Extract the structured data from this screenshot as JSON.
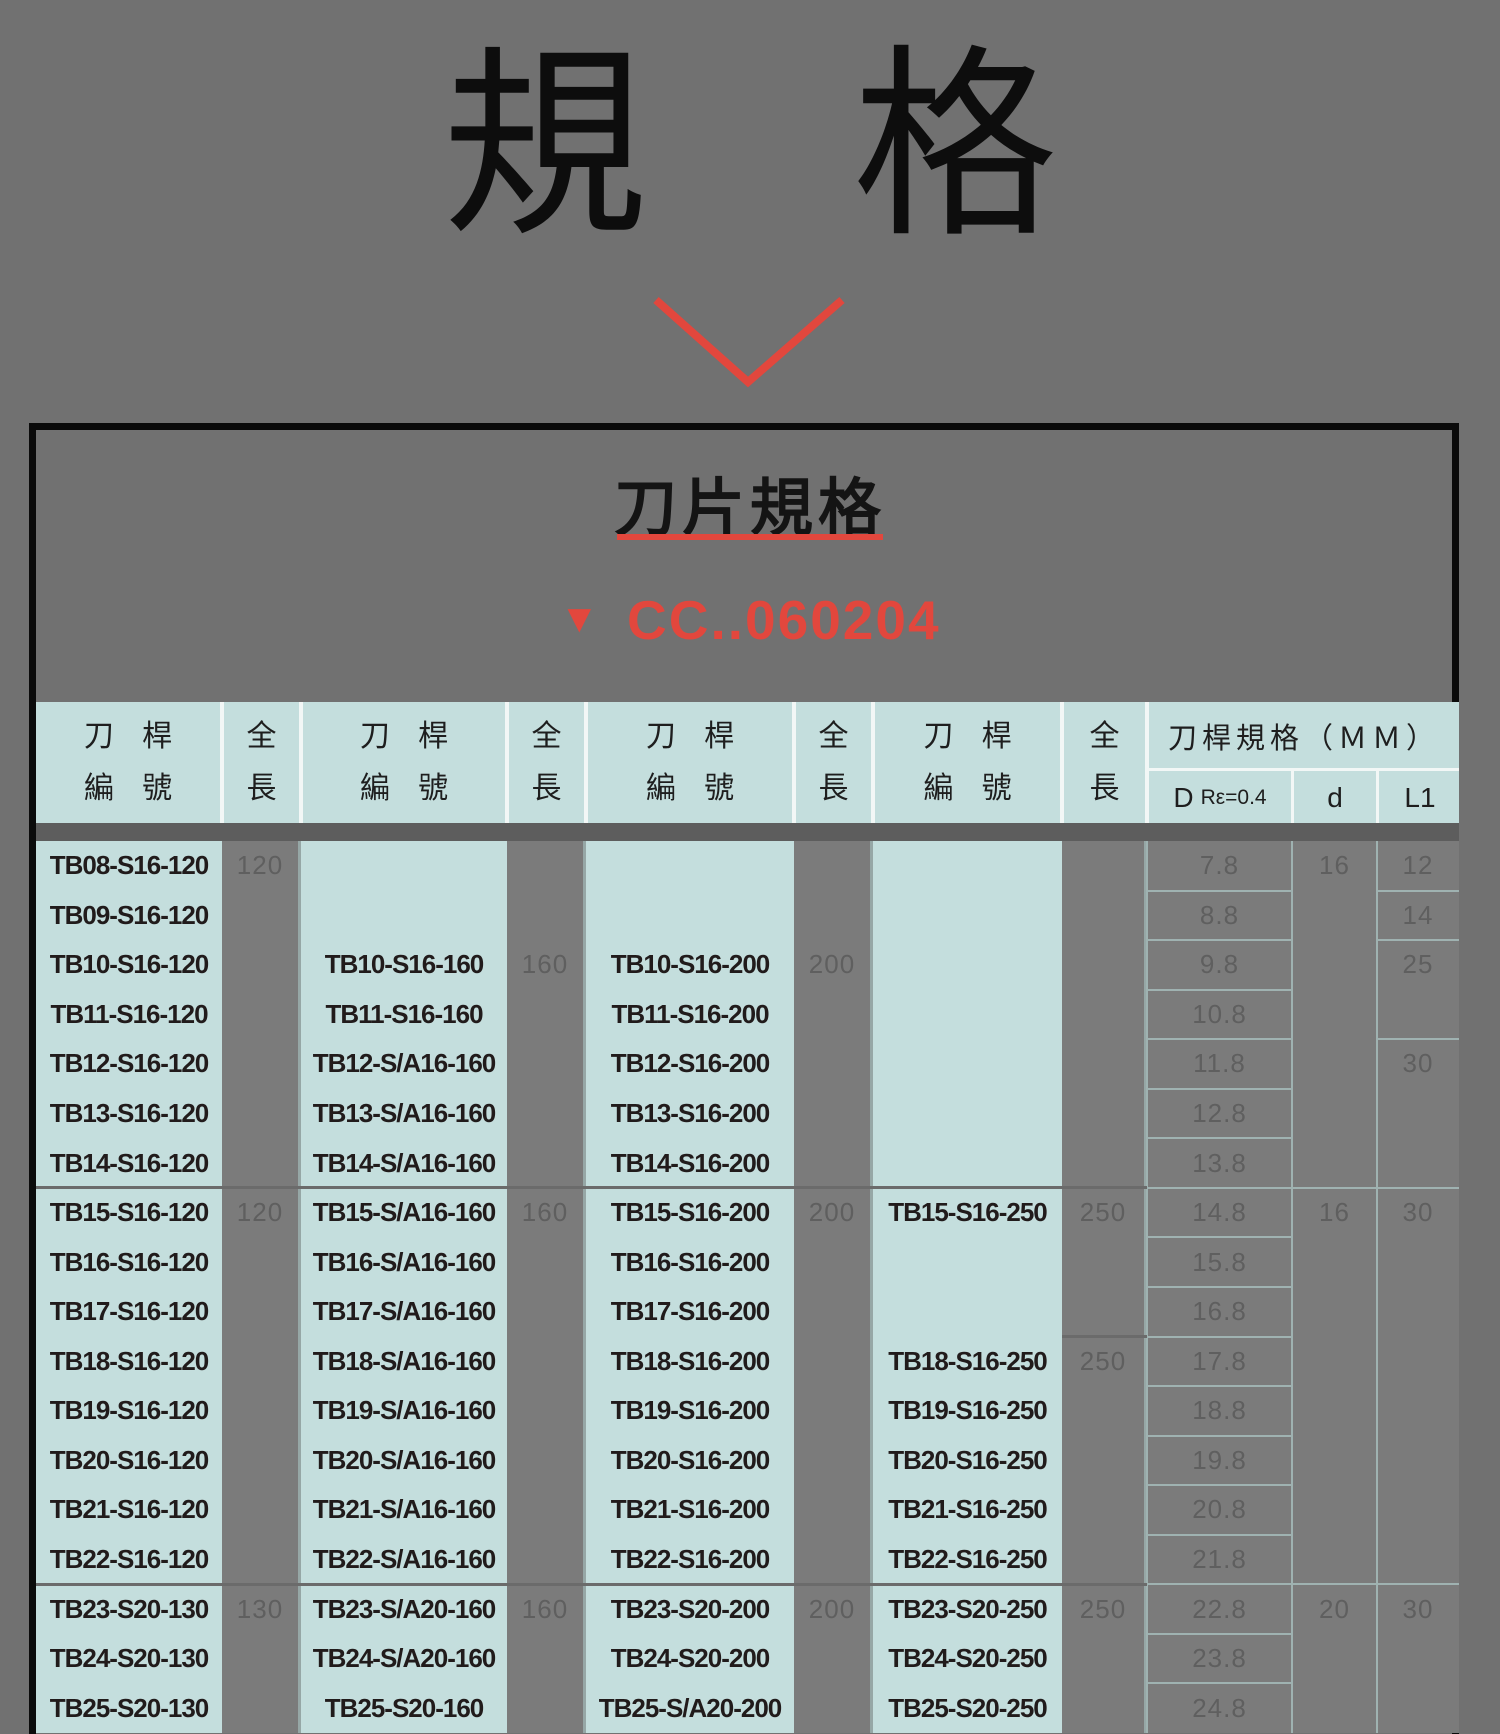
{
  "page": {
    "title": "規　格"
  },
  "panel": {
    "title": "刀片規格",
    "marker": "▼",
    "code": "CC..060204"
  },
  "colors": {
    "page_gray": "#717171",
    "cell_gray": "#7b7b7b",
    "teal": "#c4dedd",
    "red": "#e2473d",
    "band_gray": "#5d5d5d",
    "light_border": "#9fb2b1",
    "dark_text": "#211b1b",
    "muted_text": "#5f5f5f"
  },
  "table": {
    "header": {
      "holder_line1": "刀 桿",
      "holder_line2": "編 號",
      "length_line1": "全",
      "length_line2": "長",
      "spec_title": "刀桿規格（ＭＭ）",
      "sub_d_main": "D",
      "sub_d_detail": "Rε=0.4",
      "sub_shank": "d",
      "sub_l1": "L1"
    },
    "holder_cols": [
      [
        "TB08-S16-120",
        "TB09-S16-120",
        "TB10-S16-120",
        "TB11-S16-120",
        "TB12-S16-120",
        "TB13-S16-120",
        "TB14-S16-120",
        "TB15-S16-120",
        "TB16-S16-120",
        "TB17-S16-120",
        "TB18-S16-120",
        "TB19-S16-120",
        "TB20-S16-120",
        "TB21-S16-120",
        "TB22-S16-120",
        "TB23-S20-130",
        "TB24-S20-130",
        "TB25-S20-130"
      ],
      [
        "",
        "",
        "TB10-S16-160",
        "TB11-S16-160",
        "TB12-S/A16-160",
        "TB13-S/A16-160",
        "TB14-S/A16-160",
        "TB15-S/A16-160",
        "TB16-S/A16-160",
        "TB17-S/A16-160",
        "TB18-S/A16-160",
        "TB19-S/A16-160",
        "TB20-S/A16-160",
        "TB21-S/A16-160",
        "TB22-S/A16-160",
        "TB23-S/A20-160",
        "TB24-S/A20-160",
        "TB25-S20-160"
      ],
      [
        "",
        "",
        "TB10-S16-200",
        "TB11-S16-200",
        "TB12-S16-200",
        "TB13-S16-200",
        "TB14-S16-200",
        "TB15-S16-200",
        "TB16-S16-200",
        "TB17-S16-200",
        "TB18-S16-200",
        "TB19-S16-200",
        "TB20-S16-200",
        "TB21-S16-200",
        "TB22-S16-200",
        "TB23-S20-200",
        "TB24-S20-200",
        "TB25-S/A20-200"
      ],
      [
        "",
        "",
        "",
        "",
        "",
        "",
        "",
        "TB15-S16-250",
        "",
        "",
        "TB18-S16-250",
        "TB19-S16-250",
        "TB20-S16-250",
        "TB21-S16-250",
        "TB22-S16-250",
        "TB23-S20-250",
        "TB24-S20-250",
        "TB25-S20-250"
      ]
    ],
    "length_cols": [
      [
        {
          "row": 1,
          "value": "120"
        },
        {
          "row": 8,
          "value": "120"
        },
        {
          "row": 16,
          "value": "130"
        }
      ],
      [
        {
          "row": 3,
          "value": "160"
        },
        {
          "row": 8,
          "value": "160"
        },
        {
          "row": 16,
          "value": "160"
        }
      ],
      [
        {
          "row": 3,
          "value": "200"
        },
        {
          "row": 8,
          "value": "200"
        },
        {
          "row": 16,
          "value": "200"
        }
      ],
      [
        {
          "row": 8,
          "value": "250"
        },
        {
          "row": 11,
          "value": "250"
        },
        {
          "row": 16,
          "value": "250"
        }
      ]
    ],
    "d_values": [
      "7.8",
      "8.8",
      "9.8",
      "10.8",
      "11.8",
      "12.8",
      "13.8",
      "14.8",
      "15.8",
      "16.8",
      "17.8",
      "18.8",
      "19.8",
      "20.8",
      "21.8",
      "22.8",
      "23.8",
      "24.8"
    ],
    "shank_values": [
      {
        "row": 1,
        "value": "16"
      },
      {
        "row": 8,
        "value": "16"
      },
      {
        "row": 16,
        "value": "20"
      }
    ],
    "l1_values": [
      {
        "row": 1,
        "value": "12"
      },
      {
        "row": 2,
        "value": "14"
      },
      {
        "row": 3,
        "value": "25"
      },
      {
        "row": 5,
        "value": "30"
      },
      {
        "row": 8,
        "value": "30"
      },
      {
        "row": 16,
        "value": "30"
      }
    ],
    "group_borders_after_rows": [
      7,
      15
    ],
    "len4_extra_border_after_row": 10,
    "shank_borders_after_rows": [
      7,
      15
    ],
    "l1_borders_after_rows": [
      1,
      2,
      4,
      7,
      15
    ]
  }
}
